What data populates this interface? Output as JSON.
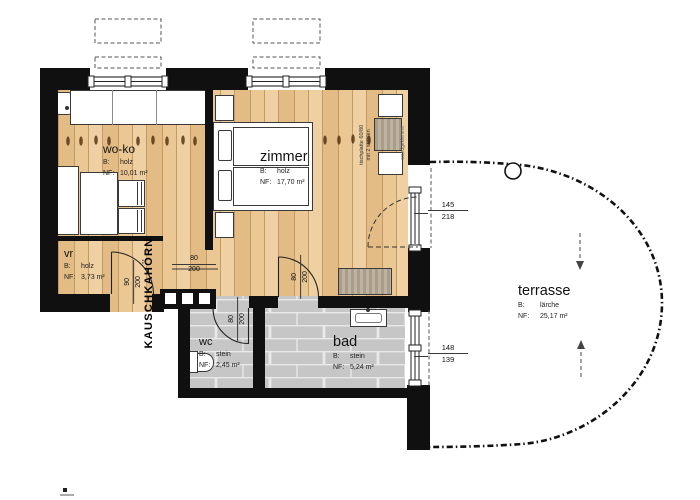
{
  "title": {
    "text": "KAUSCHKAHÖRN"
  },
  "rooms": {
    "woko": {
      "name": "wo-ko",
      "material_label": "B:",
      "material": "holz",
      "area_label": "NF:",
      "area": "10,01 m²"
    },
    "zimmer": {
      "name": "zimmer",
      "material_label": "B:",
      "material": "holz",
      "area_label": "NF:",
      "area": "17,70 m²"
    },
    "vr": {
      "name": "vr",
      "material_label": "B:",
      "material": "holz",
      "area_label": "NF:",
      "area": "3,73 m²"
    },
    "wc": {
      "name": "wc",
      "material_label": "B:",
      "material": "stein",
      "area_label": "NF:",
      "area": "2,45 m²"
    },
    "bad": {
      "name": "bad",
      "material_label": "B:",
      "material": "stein",
      "area_label": "NF:",
      "area": "5,24 m²"
    },
    "terrasse": {
      "name": "terrasse",
      "material_label": "B:",
      "material": "lärche",
      "area_label": "NF:",
      "area": "25,17 m²"
    }
  },
  "dims": {
    "corridor": {
      "w": "80",
      "h": "200"
    },
    "vr_door": {
      "w": "90",
      "h": "200"
    },
    "wc_door": {
      "w": "80",
      "h": "200"
    },
    "bad_door": {
      "w": "80",
      "h": "200"
    },
    "terrace_door": {
      "w": "145",
      "h": "218"
    },
    "bad_window": {
      "w": "148",
      "h": "139"
    }
  },
  "annotations": {
    "table_note_1": "tischplatte 60/80",
    "table_note_2": "mit 2 stühlen",
    "table_note_side": "wandgeklemmt"
  },
  "colors": {
    "wall": "#101010",
    "wood": "#e8c18c",
    "stone": "#c6c6c6",
    "line": "#222222"
  }
}
